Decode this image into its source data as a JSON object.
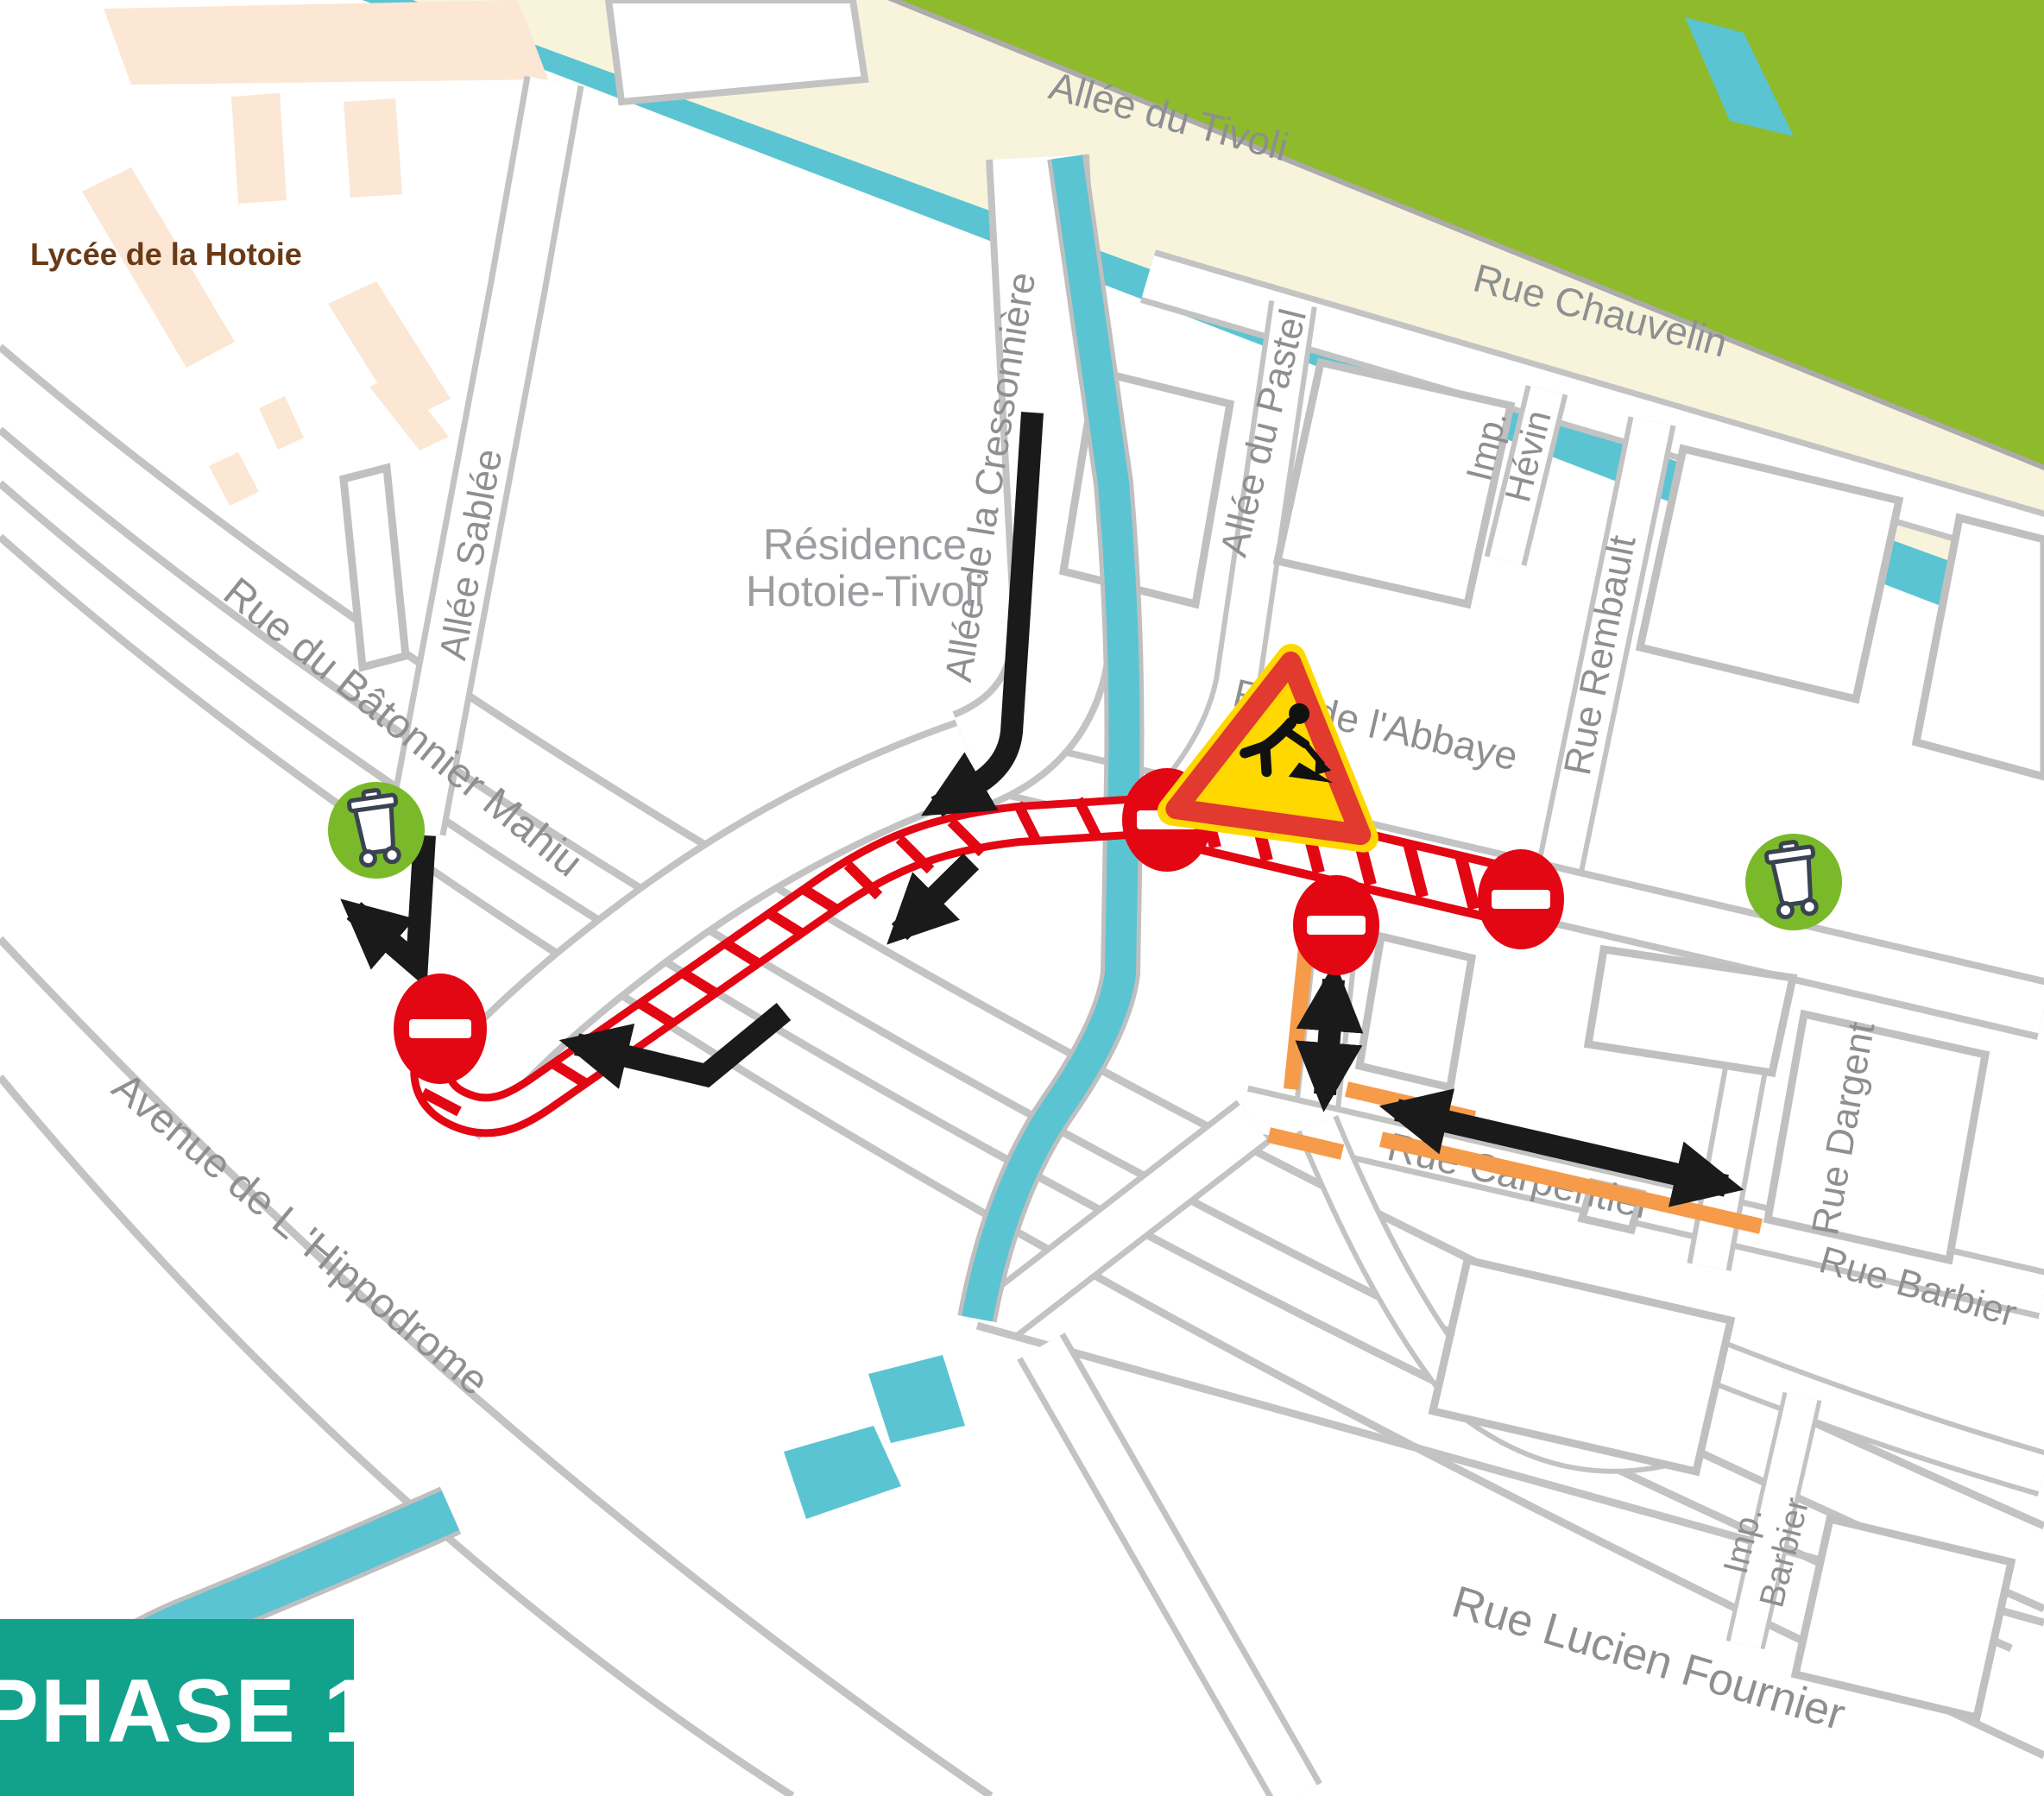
{
  "badge": {
    "label": "PHASE 1"
  },
  "areas": {
    "lycee": "Lycée de la Hotoie",
    "residence_line1": "Résidence",
    "residence_line2": "Hotoie-Tivoli"
  },
  "streets": {
    "tivoli": "Allée du Tivoli",
    "chauvelin": "Rue Chauvelin",
    "pastel": "Allée du Pastel",
    "hevin_line1": "Imp.",
    "hevin_line2": "Hévin",
    "rembault": "Rue Rembault",
    "abbaye": "Rue de l'Abbaye",
    "cressonniere": "Allée de la Cressonnière",
    "sablee": "Allée Sablée",
    "mahiu": "Rue du Bâtonnier Mahiu",
    "hippodrome": "Avenue de L 'Hippodrome",
    "carpentier": "Rue  Carpentier",
    "dargent": "Rue Dargent",
    "barbier": "Rue Barbier",
    "imp_barbier_line1": "Imp.",
    "imp_barbier_line2": "Barbier",
    "fournier": "Rue Lucien Fournier"
  },
  "icons": {
    "roadworks": "roadworks-warning-sign",
    "no_entry": "no-entry-sign",
    "bin": "waste-collection-point",
    "arrow": "detour-direction-arrow"
  },
  "colors": {
    "closure_red": "#E30613",
    "detour_orange": "#F59B49",
    "water_cyan": "#5BC4D2",
    "park_green": "#8FBA2C",
    "path_cream": "#F8F4DB",
    "badge_teal": "#12A28C",
    "building_peach": "#FBE7D4",
    "label_gray": "#8D8F91",
    "casing_gray": "#C3C3C3",
    "building_gray": "#C0C0C0",
    "bin_green": "#7AB929",
    "sign_yellow": "#FFD800",
    "sign_red_border": "#E23A2E",
    "arrow_black": "#1A1A1A"
  }
}
